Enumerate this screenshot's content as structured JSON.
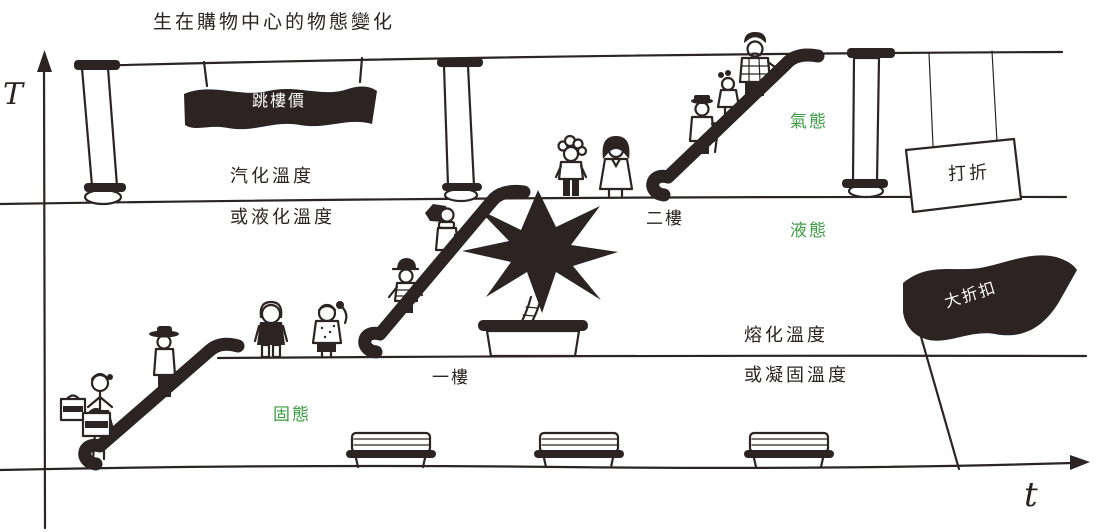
{
  "title": "生在購物中心的物態變化",
  "axes": {
    "y": "T",
    "x": "t"
  },
  "floors": {
    "upper_boundary_above": "汽化溫度",
    "upper_boundary_below": "或液化溫度",
    "lower_boundary_above": "熔化溫度",
    "lower_boundary_below": "或凝固溫度",
    "second_floor": "二樓",
    "first_floor": "一樓"
  },
  "states": {
    "gas": "氣態",
    "liquid": "液態",
    "solid": "固態"
  },
  "signs": {
    "hanging_banner": "跳樓價",
    "discount_sign": "打折",
    "flag": "大折扣"
  },
  "colors": {
    "ink": "#2b2422",
    "background": "#ffffff",
    "state_green": "#3a9d42",
    "banner_text": "#ffffff"
  }
}
